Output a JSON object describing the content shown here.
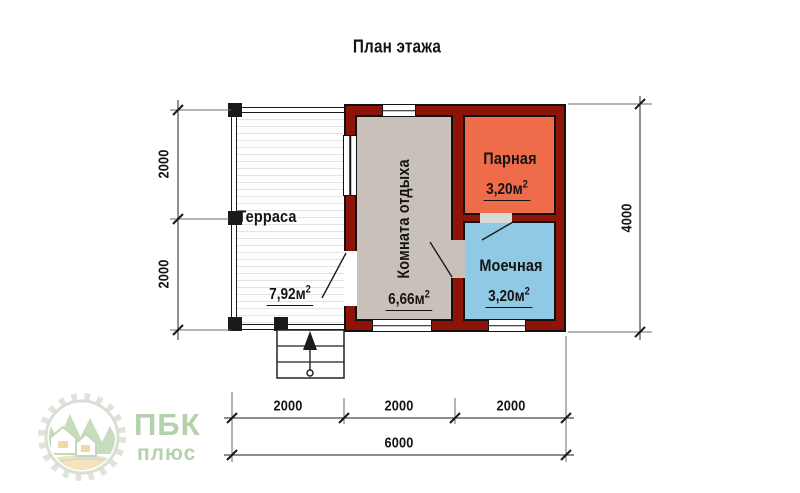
{
  "title": "План этажа",
  "plan": {
    "rooms": [
      {
        "id": "terrace",
        "name": "Терраса",
        "area": "7,92м",
        "area_sup": "2"
      },
      {
        "id": "rest",
        "name": "Комната отдыха",
        "area": "6,66м",
        "area_sup": "2"
      },
      {
        "id": "steam",
        "name": "Парная",
        "area": "3,20м",
        "area_sup": "2"
      },
      {
        "id": "wash",
        "name": "Моечная",
        "area": "3,20м",
        "area_sup": "2"
      }
    ]
  },
  "dimensions": {
    "left": [
      "2000",
      "2000"
    ],
    "right": "4000",
    "bottom": [
      "2000",
      "2000",
      "2000"
    ],
    "total": "6000"
  },
  "logo": {
    "title": "ПБК",
    "subtitle": "плюс"
  },
  "colors": {
    "wall": "#8e1309",
    "steam": "#ee6c4a",
    "wash": "#8fc9e3",
    "rest": "#c9c1b9",
    "terrace": "#ffffff",
    "logo_green": "#a6c99d",
    "logo_tan": "#f3dfb0"
  }
}
